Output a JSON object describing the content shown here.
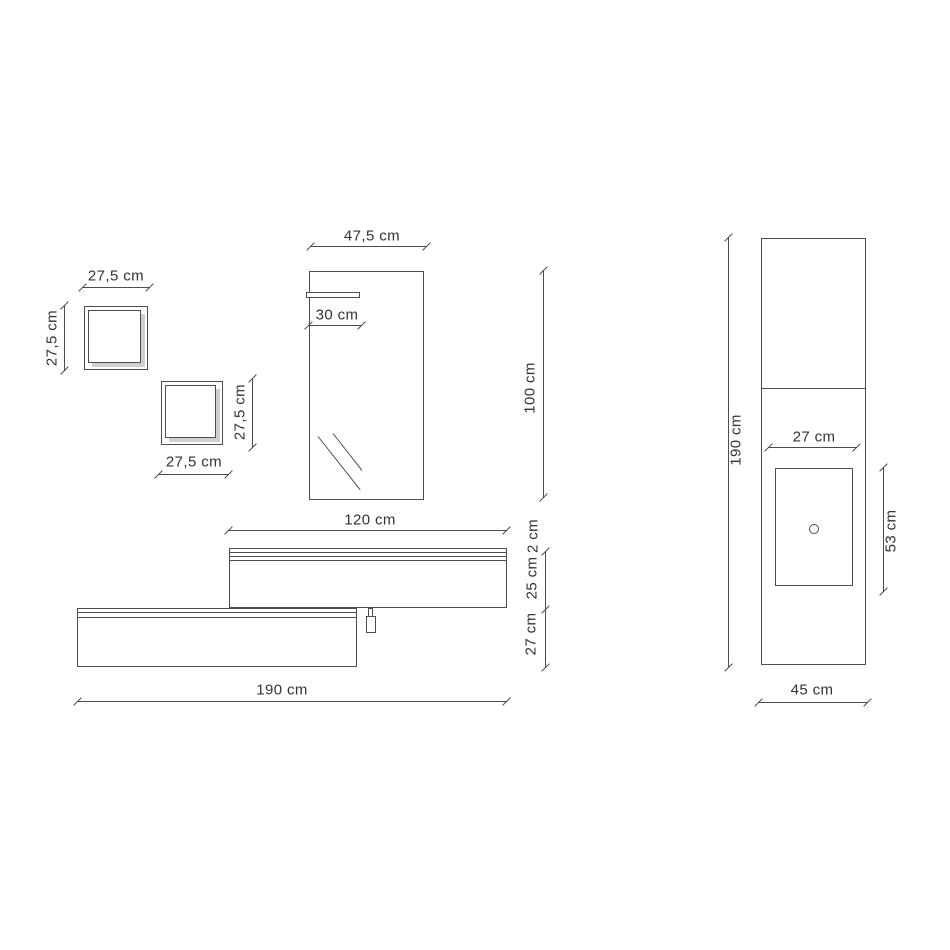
{
  "drawing": {
    "type": "furniture-technical-drawing",
    "colors": {
      "background": "#ffffff",
      "line": "#4d4d4d",
      "text": "#333333",
      "frame_shading": "#cfcfcf"
    },
    "labels": {
      "cube1_width": "27,5 cm",
      "cube1_height": "27,5 cm",
      "cube2_height": "27,5 cm",
      "cube2_width": "27,5 cm",
      "mirror_width": "47,5 cm",
      "mirror_shelf_width": "30 cm",
      "mirror_height": "100 cm",
      "vanity_top_width": "120 cm",
      "vanity_top_thickness": "2 cm",
      "vanity_upper_height": "25 cm",
      "vanity_lower_height": "27 cm",
      "vanity_total_width": "190 cm",
      "column_height": "190 cm",
      "basin_width": "27 cm",
      "basin_height": "53 cm",
      "column_depth": "45 cm"
    }
  }
}
